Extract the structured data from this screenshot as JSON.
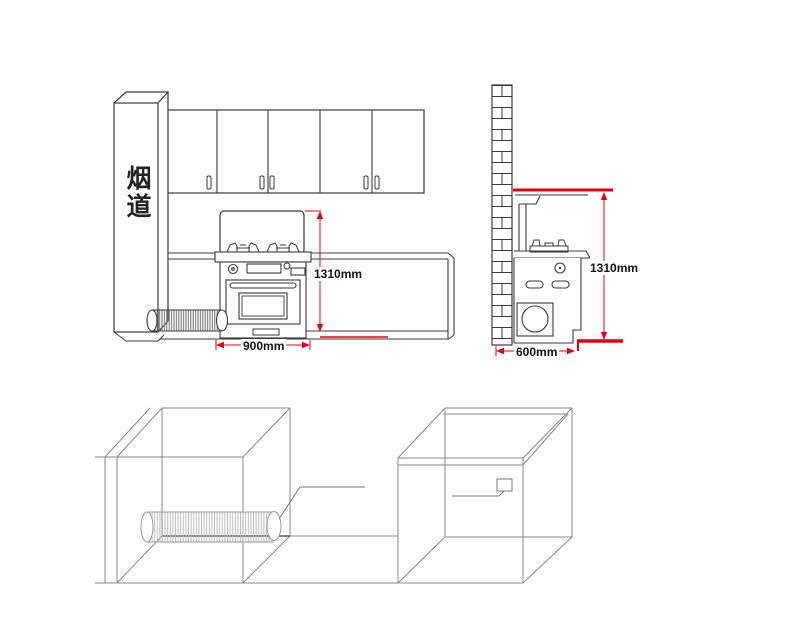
{
  "labels": {
    "flue_duct": "烟道",
    "front_view_height": "1310mm",
    "front_view_width": "900mm",
    "side_view_height": "1310mm",
    "side_view_depth": "600mm"
  },
  "colors": {
    "dimension_red": "#e60012",
    "outline_dark": "#3a3a3a",
    "wireframe_gray": "#8a8a8a",
    "text": "#111111",
    "background": "#ffffff"
  }
}
